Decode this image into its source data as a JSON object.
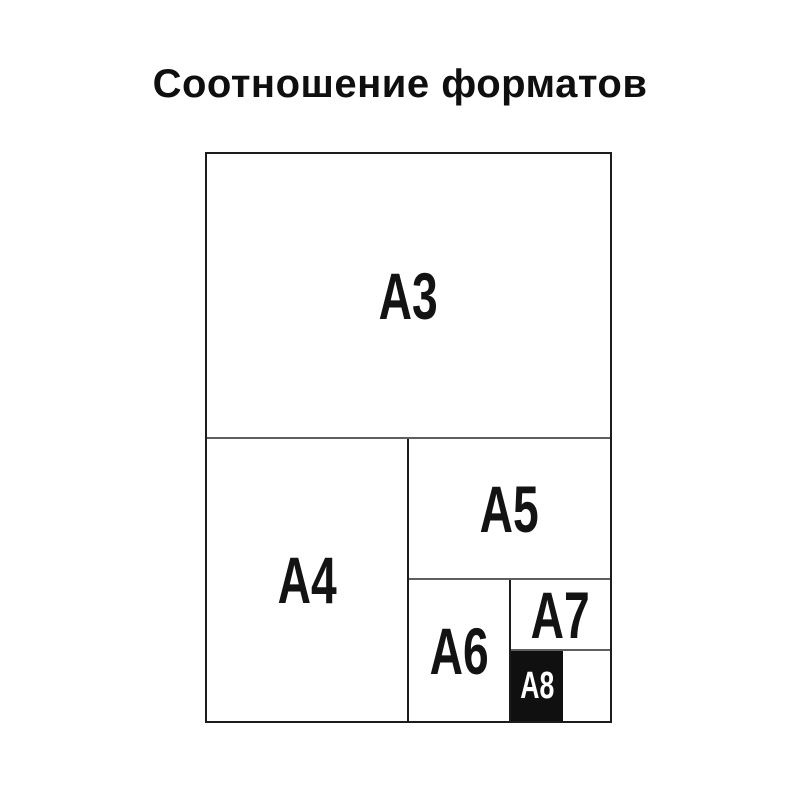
{
  "title": "Соотношение форматов",
  "diagram": {
    "formats": [
      {
        "id": "a3",
        "label": "A3",
        "filled": false
      },
      {
        "id": "a4",
        "label": "A4",
        "filled": false
      },
      {
        "id": "a5",
        "label": "A5",
        "filled": false
      },
      {
        "id": "a6",
        "label": "A6",
        "filled": false
      },
      {
        "id": "a7",
        "label": "A7",
        "filled": false
      },
      {
        "id": "a8",
        "label": "A8",
        "filled": true
      }
    ]
  },
  "colors": {
    "background": "#ffffff",
    "title_text": "#0f0f0f",
    "label_text": "#131313",
    "outer_border": "#1c1c1c",
    "horizontal_divider": "#5f5f5f",
    "highlight_fill": "#101010",
    "highlight_text": "#ffffff"
  }
}
